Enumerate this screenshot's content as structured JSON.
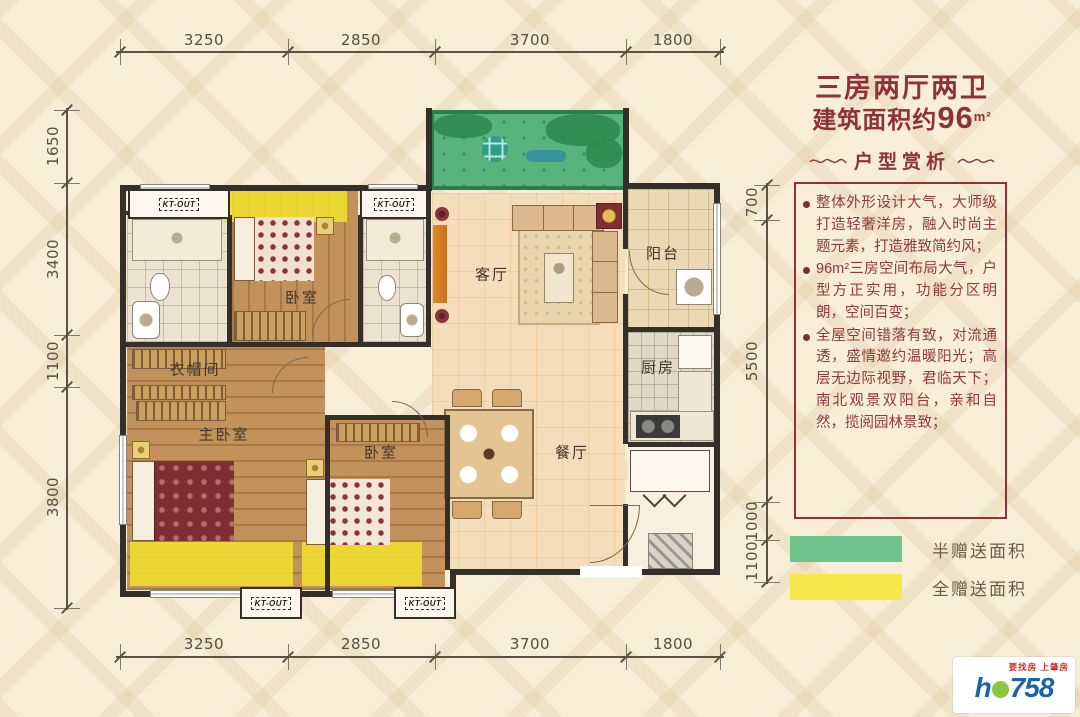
{
  "title": {
    "line1": "三房两厅两卫",
    "line2_prefix": "建筑面积约",
    "line2_num": "96",
    "line2_unit": "m²"
  },
  "panel": {
    "header": "户型赏析",
    "bullets": [
      "整体外形设计大气，大师级打造轻奢洋房，融入时尚主题元素，打造雅致简约风；",
      "96m²三房空间布局大气，户型方正实用，功能分区明朗，空间百变；",
      "全屋空间错落有致，对流通透，盛情邀约温暖阳光；高层无边际视野，君临天下；南北观景双阳台，亲和自然，揽阅园林景致；"
    ]
  },
  "legend": {
    "half": {
      "label": "半赠送面积",
      "color": "#6ec28d"
    },
    "full": {
      "label": "全赠送面积",
      "color": "#f6e84a"
    }
  },
  "dims": {
    "top": [
      "3250",
      "2850",
      "3700",
      "1800"
    ],
    "bottom": [
      "3250",
      "2850",
      "3700",
      "1800"
    ],
    "left": [
      "1650",
      "3400",
      "1100",
      "3800"
    ],
    "right": [
      "700",
      "5500",
      "1000",
      "1100"
    ]
  },
  "rooms": {
    "living": "客厅",
    "dining": "餐厅",
    "kitchen": "厨房",
    "balcony": "阳台",
    "bedroom_top": "卧室",
    "bedroom_bottom": "卧室",
    "master": "主卧室",
    "closet": "衣帽间"
  },
  "plan": {
    "ac_unit_label": "KT-OUT"
  },
  "logo": {
    "slogan": "要找房 上肇房",
    "brand_prefix": "h",
    "brand_suffix": "758"
  },
  "colors": {
    "accent_maroon": "#8e3237",
    "gift_green": "#58b37c",
    "gift_yellow": "#f2e23e",
    "wall": "#33302a"
  }
}
